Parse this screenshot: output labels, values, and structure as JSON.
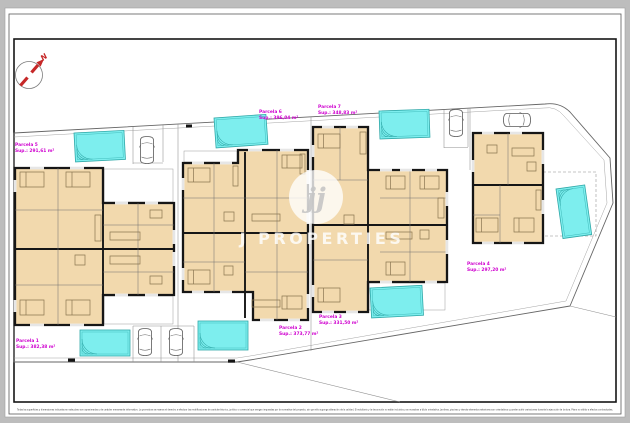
{
  "colors": {
    "page_background": "#bdbdbd",
    "sheet": "#ffffff",
    "wall": "#161616",
    "room_fill": "#f2d9ad",
    "pool_fill": "#7deeee",
    "pool_edge": "#2fa8a8",
    "parcel_label": "#cf00cf",
    "compass_red": "#c62828"
  },
  "compass": {
    "label": "N"
  },
  "watermark": {
    "monogram": "jj",
    "wordmark": "J PROPERTIES"
  },
  "parcels": [
    {
      "name": "Parcela 1",
      "area": "Sup.: 382,38 m²"
    },
    {
      "name": "Parcela 2",
      "area": "Sup.: 373,77 m²"
    },
    {
      "name": "Parcela 3",
      "area": "Sup.: 331,50 m²"
    },
    {
      "name": "Parcela 4",
      "area": "Sup.: 297,20 m²"
    },
    {
      "name": "Parcela 5",
      "area": "Sup.: 291,61 m²"
    },
    {
      "name": "Parcela 6",
      "area": "Sup.: 396,04 m²"
    },
    {
      "name": "Parcela 7",
      "area": "Sup.: 348,83 m²"
    }
  ],
  "disclaimer": "Todas las superficies y dimensiones indicadas en este plano son aproximadas y de carácter meramente informativo. La promotora se reserva el derecho a efectuar las modificaciones de carácter técnico, jurídico o comercial que vengan impuestas por la normativa del proyecto, sin que ello suponga alteración de la calidad. El mobiliario y la decoración no están incluidos y se muestran a título orientativo. Jardines, piscinas y demás elementos exteriores son orientativos y pueden sufrir variaciones durante la ejecución de la obra. Plano no válido a efectos contractuales."
}
